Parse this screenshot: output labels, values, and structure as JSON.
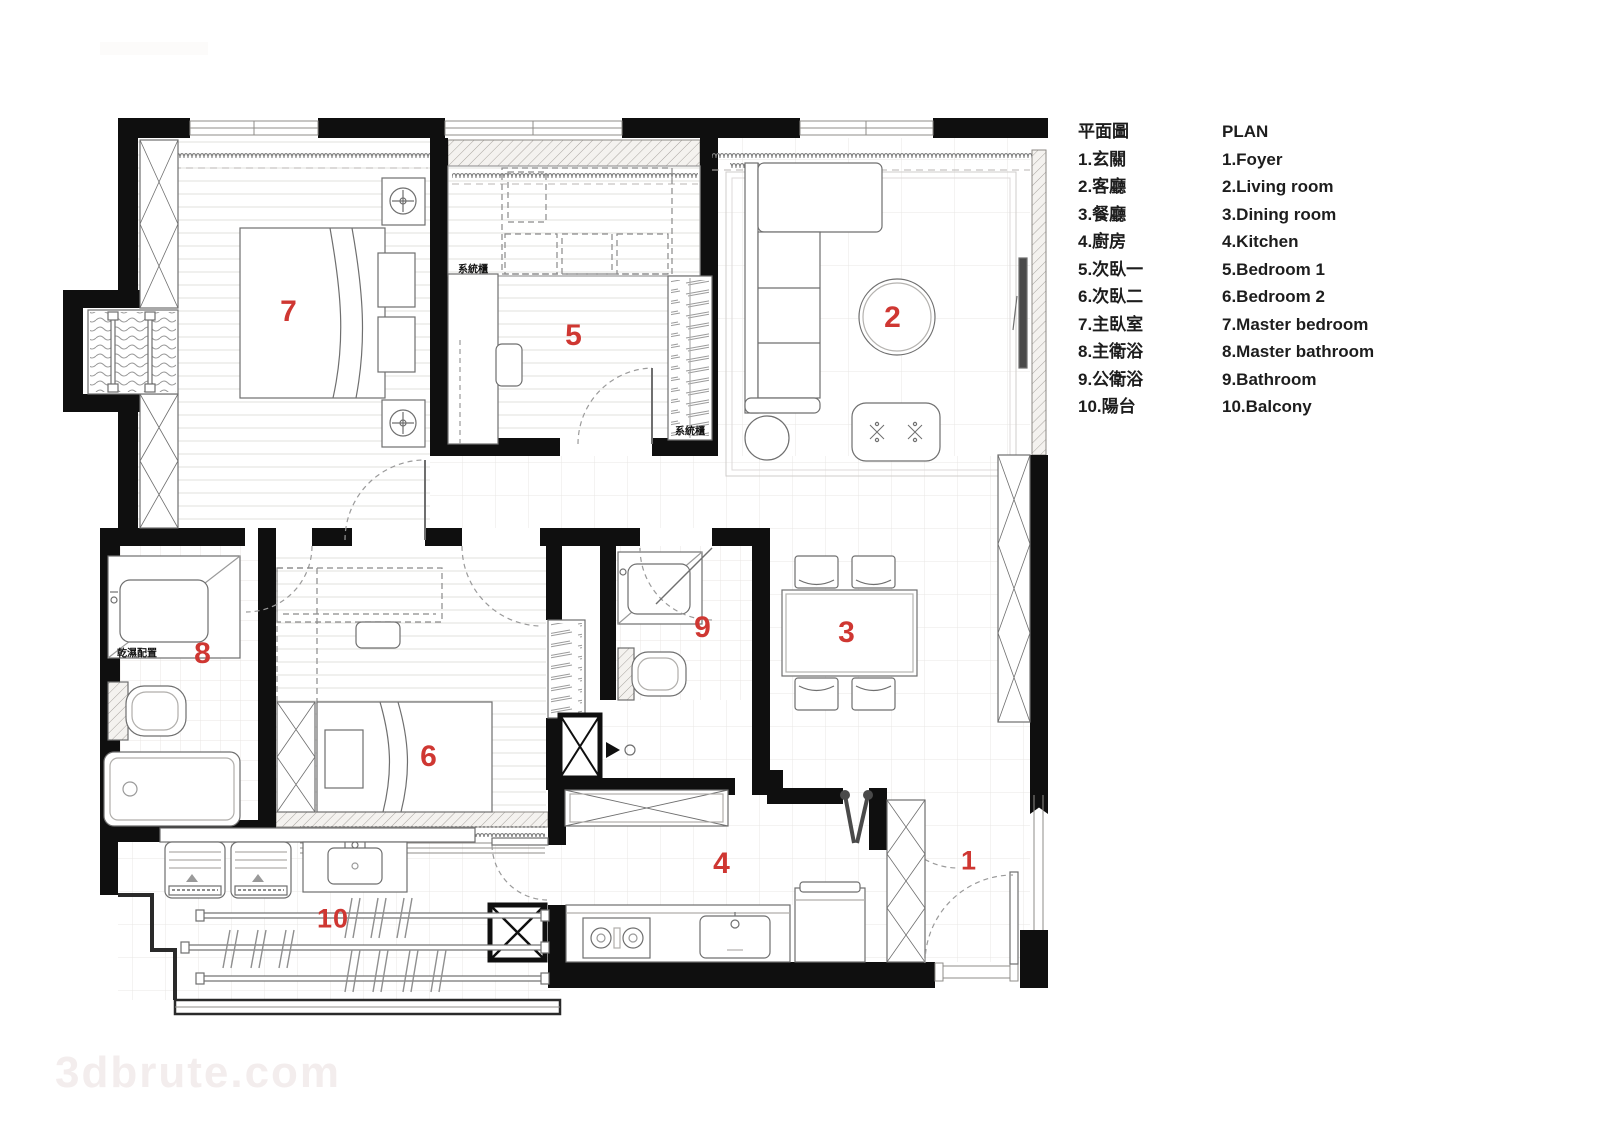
{
  "page": {
    "watermark_bottom": "3dbrute.com"
  },
  "plan": {
    "rooms": [
      {
        "label": "1",
        "zh": "玄關",
        "en": "Foyer"
      },
      {
        "label": "2",
        "zh": "客廳",
        "en": "Living room"
      },
      {
        "label": "3",
        "zh": "餐廳",
        "en": "Dining room"
      },
      {
        "label": "4",
        "zh": "廚房",
        "en": "Kitchen"
      },
      {
        "label": "5",
        "zh": "次臥一",
        "en": "Bedroom 1"
      },
      {
        "label": "6",
        "zh": "次臥二",
        "en": "Bedroom 2"
      },
      {
        "label": "7",
        "zh": "主臥室",
        "en": "Master bedroom"
      },
      {
        "label": "8",
        "zh": "主衛浴",
        "en": "Master bathroom"
      },
      {
        "label": "9",
        "zh": "公衛浴",
        "en": "Bathroom"
      },
      {
        "label": "10",
        "zh": "陽台",
        "en": "Balcony"
      }
    ],
    "annotations": {
      "system_cabinet_a": "系統櫃",
      "system_cabinet_b": "系統櫃",
      "dry_wet_config": "乾濕配置"
    },
    "colors": {
      "room_number": "#cf3732",
      "wall": "#0f0f0f"
    }
  },
  "legend": {
    "zh": {
      "title": "平面圖",
      "items": [
        "1.玄關",
        "2.客廳",
        "3.餐廳",
        "4.廚房",
        "5.次臥一",
        "6.次臥二",
        "7.主臥室",
        "8.主衛浴",
        "9.公衛浴",
        "10.陽台"
      ]
    },
    "en": {
      "title": "PLAN",
      "items": [
        "1.Foyer",
        "2.Living room",
        "3.Dining room",
        "4.Kitchen",
        "5.Bedroom 1",
        "6.Bedroom 2",
        "7.Master bedroom",
        "8.Master bathroom",
        "9.Bathroom",
        "10.Balcony"
      ]
    }
  }
}
